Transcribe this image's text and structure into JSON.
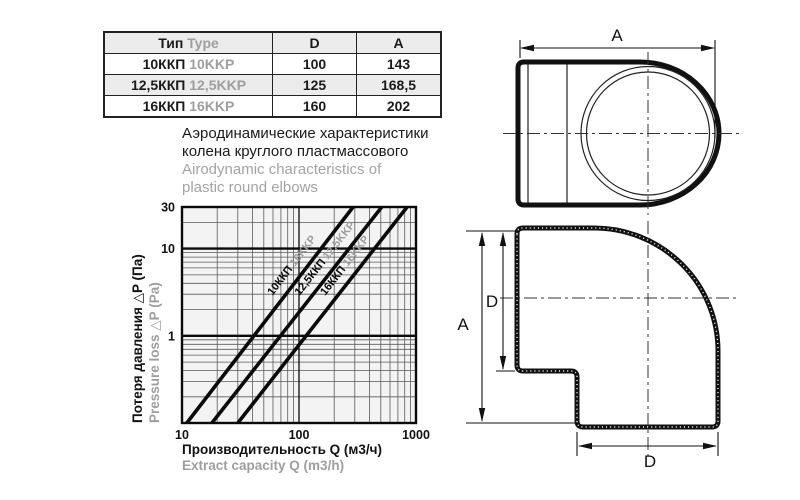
{
  "table": {
    "header": {
      "type_ru": "Тип",
      "type_en": "Type",
      "d": "D",
      "a": "A"
    },
    "rows": [
      {
        "ru": "10ККП",
        "en": "10KKP",
        "d": "100",
        "a": "143"
      },
      {
        "ru": "12,5ККП",
        "en": "12,5KKP",
        "d": "125",
        "a": "168,5"
      },
      {
        "ru": "16ККП",
        "en": "16KKP",
        "d": "160",
        "a": "202"
      }
    ]
  },
  "title": {
    "ru_line1": "Аэродинамические характеристики",
    "ru_line2": "колена круглого пластмассового",
    "en_line1": "Airodynamic characteristics of",
    "en_line2": "plastic round elbows"
  },
  "chart_data": {
    "type": "line",
    "scale": "log-log",
    "x_axis": {
      "label_ru": "Производительность Q (м3/ч)",
      "label_en": "Extract capacity Q (m3/h)",
      "min": 10,
      "max": 1000,
      "ticks": [
        10,
        100,
        1000
      ]
    },
    "y_axis": {
      "label_ru": "Потеря давления △P (Па)",
      "label_en": "Pressure loss △P (Pa)",
      "min": 0.1,
      "max": 30,
      "ticks": [
        30,
        10,
        1
      ]
    },
    "series": [
      {
        "name_ru": "10ККП",
        "name_en": "10KKP",
        "points": [
          [
            11,
            0.1
          ],
          [
            290,
            30
          ]
        ]
      },
      {
        "name_ru": "12,5ККП",
        "name_en": "12,5KKP",
        "points": [
          [
            18,
            0.1
          ],
          [
            510,
            30
          ]
        ]
      },
      {
        "name_ru": "16ККП",
        "name_en": "16KKP",
        "points": [
          [
            30,
            0.1
          ],
          [
            840,
            30
          ]
        ]
      }
    ],
    "grid": "log minor gridlines on both axes, heavy lines at ΔP=1 and ΔP=10",
    "colors": {
      "line": "#0a0a0a",
      "grid_minor": "#5a5a5a",
      "plot_bg": "#f3f3f3",
      "secondary_text": "#9e9e9e"
    }
  },
  "drawings": {
    "top_view": {
      "dim_a": "A"
    },
    "side_view": {
      "dim_a": "A",
      "dim_d_inlet": "D",
      "dim_d_outlet": "D"
    }
  }
}
